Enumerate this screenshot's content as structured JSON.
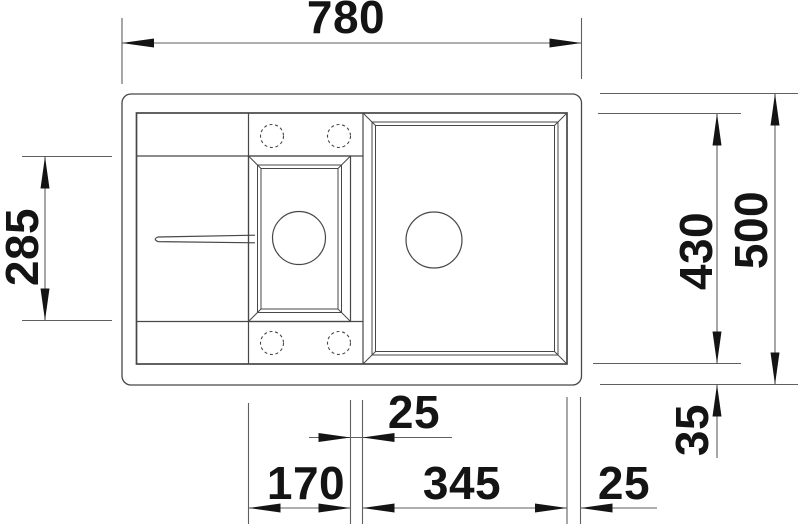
{
  "drawing": {
    "background": "#ffffff",
    "line_color": "#474747",
    "dimension_line_color": "#5f5f5f",
    "text_color": "#141414",
    "dimensions": {
      "overall_width": "780",
      "overall_depth": "500",
      "bowl_area_depth": "430",
      "drainer_depth": "285",
      "bottom_rim_offset": "35",
      "bowl_gap": "25",
      "small_bowl_width": "170",
      "main_bowl_width": "345",
      "right_rim_offset": "25"
    }
  }
}
